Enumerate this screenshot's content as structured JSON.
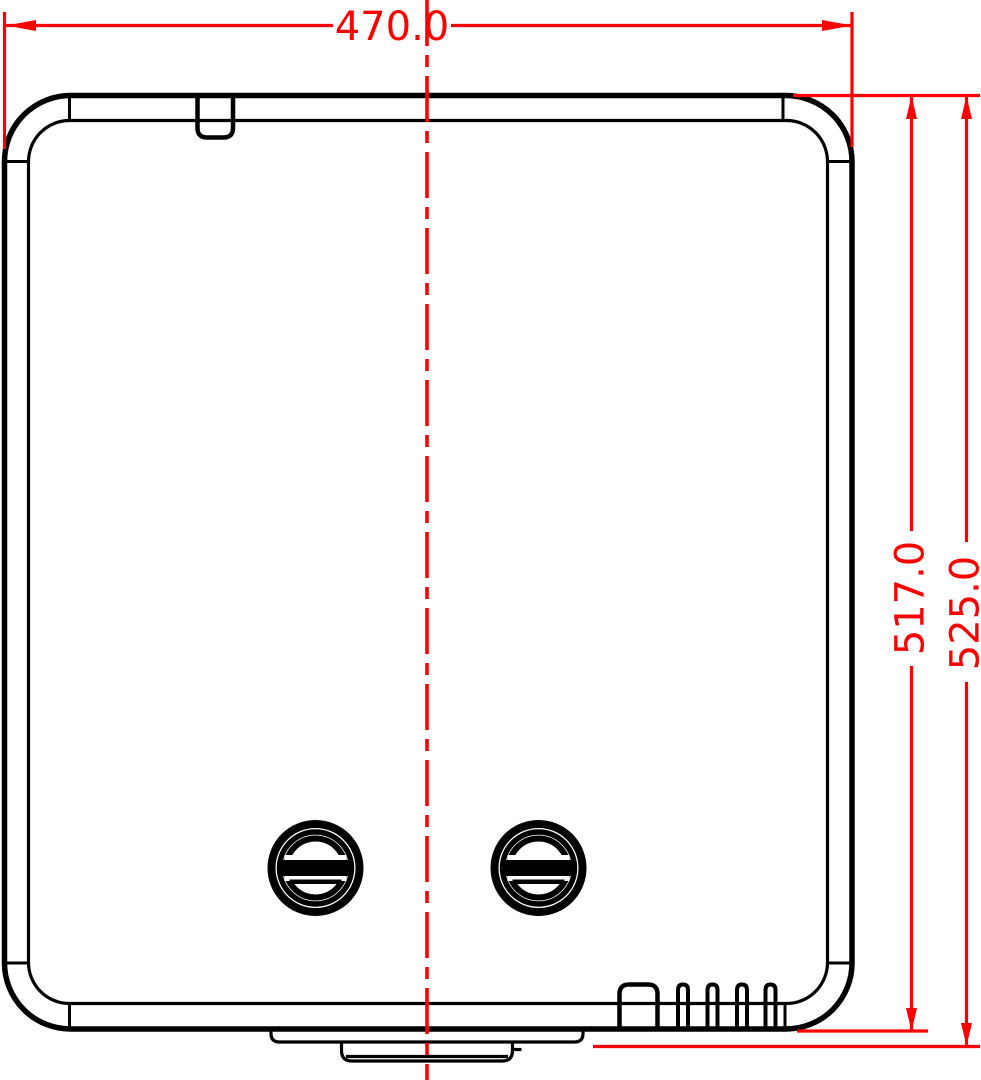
{
  "drawing": {
    "kind": "technical-dimension-drawing",
    "units": "mm",
    "dimensions": {
      "width": {
        "label": "470.0",
        "value_mm": 470.0,
        "orientation": "horizontal"
      },
      "body_height": {
        "label": "517.0",
        "value_mm": 517.0,
        "orientation": "vertical"
      },
      "overall_height": {
        "label": "525.0",
        "value_mm": 525.0,
        "orientation": "vertical"
      }
    },
    "features": {
      "screw_count": 2,
      "narrow_vent_slots": 4,
      "wide_vent_slots": 1,
      "top_tab_count": 1
    }
  },
  "style": {
    "dimension_color": "#ff0000",
    "line_color": "#000000",
    "background": "#ffffff"
  }
}
